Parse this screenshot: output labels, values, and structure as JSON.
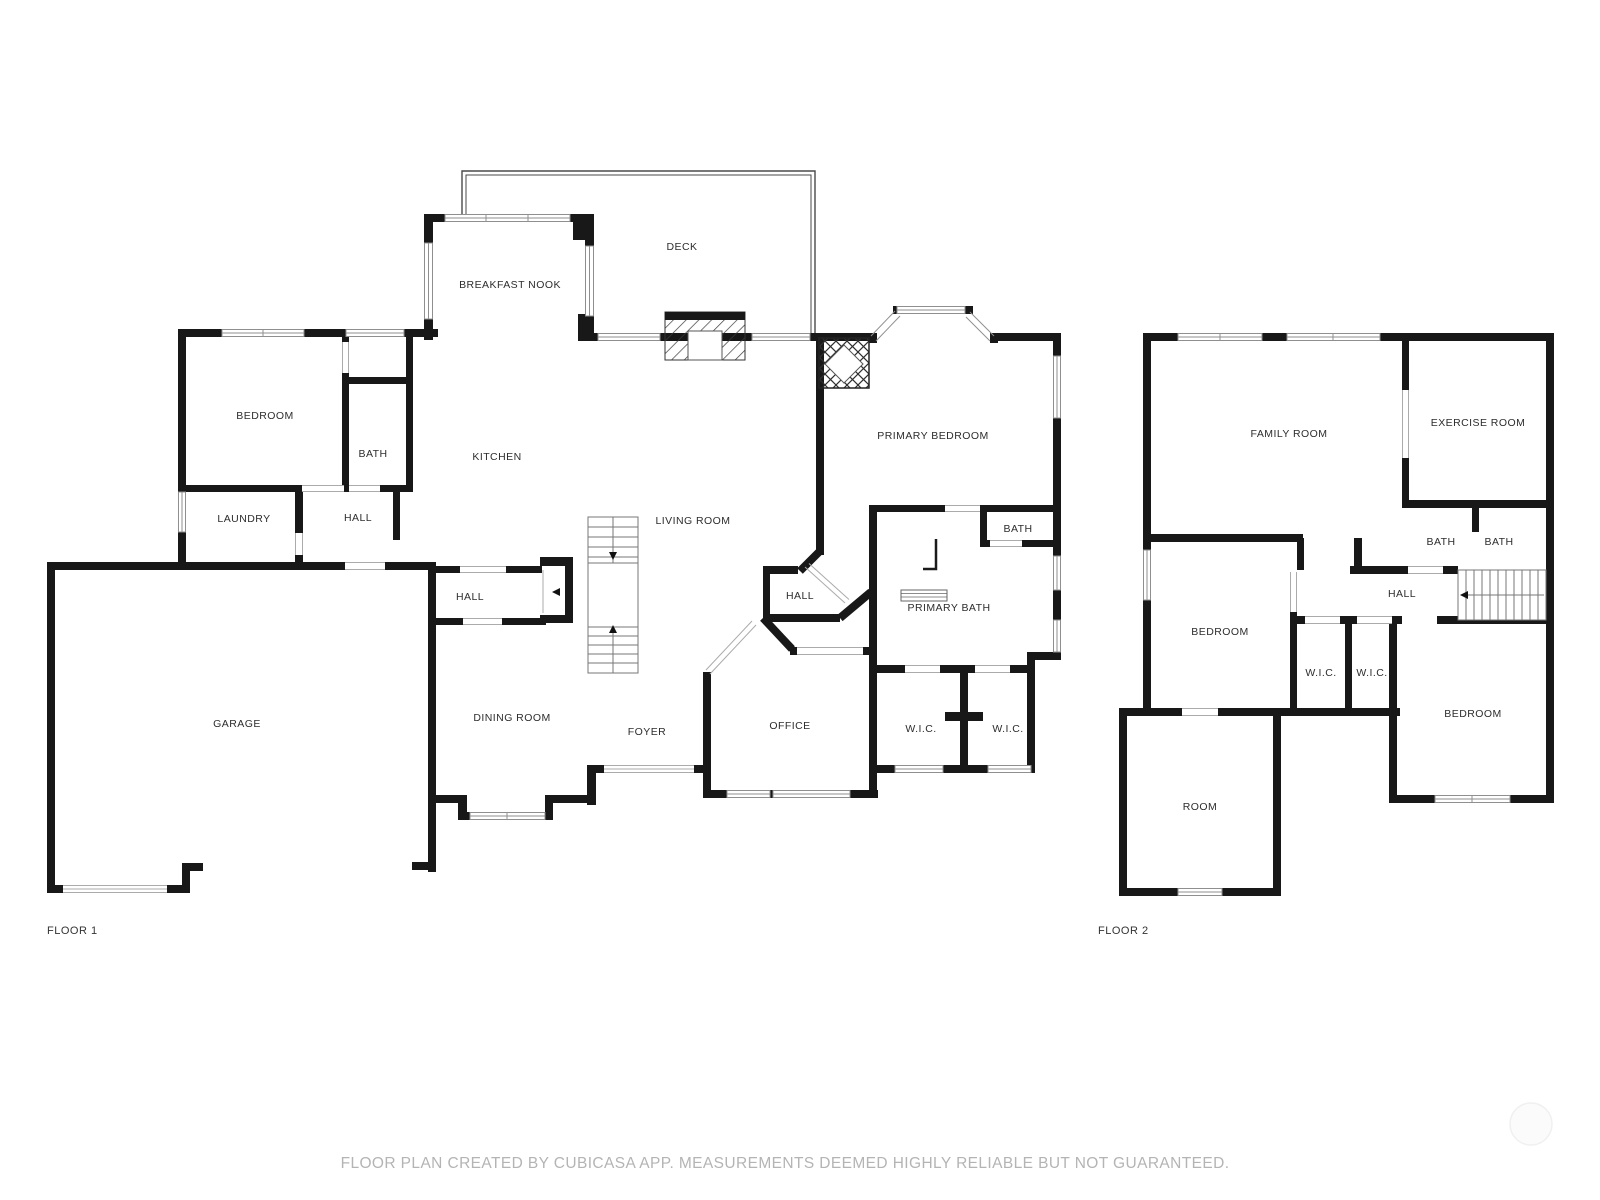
{
  "floor1": {
    "name": "FLOOR 1",
    "rooms": [
      {
        "label": "DECK"
      },
      {
        "label": "BREAKFAST NOOK"
      },
      {
        "label": "BEDROOM"
      },
      {
        "label": "BATH"
      },
      {
        "label": "KITCHEN"
      },
      {
        "label": "LAUNDRY"
      },
      {
        "label": "HALL"
      },
      {
        "label": "LIVING ROOM"
      },
      {
        "label": "PRIMARY BEDROOM"
      },
      {
        "label": "BATH"
      },
      {
        "label": "HALL"
      },
      {
        "label": "PRIMARY BATH"
      },
      {
        "label": "HALL"
      },
      {
        "label": "GARAGE"
      },
      {
        "label": "DINING ROOM"
      },
      {
        "label": "FOYER"
      },
      {
        "label": "OFFICE"
      },
      {
        "label": "W.I.C."
      },
      {
        "label": "W.I.C."
      }
    ]
  },
  "floor2": {
    "name": "FLOOR 2",
    "rooms": [
      {
        "label": "FAMILY ROOM"
      },
      {
        "label": "EXERCISE ROOM"
      },
      {
        "label": "BATH"
      },
      {
        "label": "BATH"
      },
      {
        "label": "HALL"
      },
      {
        "label": "BEDROOM"
      },
      {
        "label": "W.I.C."
      },
      {
        "label": "W.I.C."
      },
      {
        "label": "BEDROOM"
      },
      {
        "label": "ROOM"
      }
    ]
  },
  "footer": {
    "disclaimer": "FLOOR PLAN CREATED BY CUBICASA APP. MEASUREMENTS DEEMED HIGHLY RELIABLE BUT NOT GUARANTEED."
  },
  "colors": {
    "wall": "#181818",
    "window_frame": "#8f8f8f",
    "label_text": "#2d2d2d",
    "footer_text": "#b4b4b4"
  }
}
